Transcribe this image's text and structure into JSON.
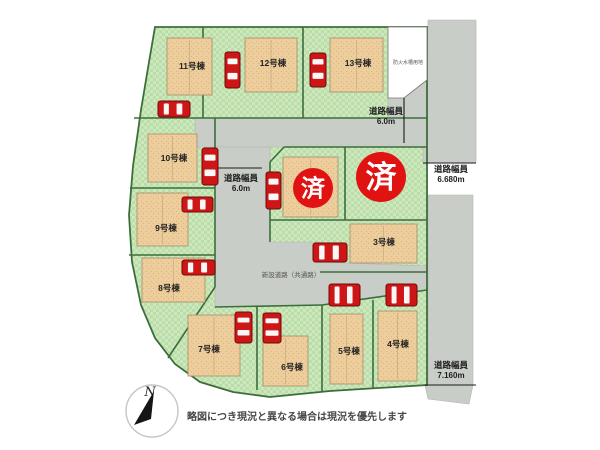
{
  "map": {
    "background": "#ffffff",
    "palette": {
      "grass": "#badda9",
      "grass_alt": "#cde8bd",
      "sand": "#edcd9c",
      "sand_dot": "#d9b57f",
      "road": "#c9cdc7",
      "road_edge": "#b2b6b0",
      "line": "#3c6e3c",
      "building_stroke": "#a38f6b",
      "building_inner": "#c8a97c",
      "car_red": "#cf1616",
      "car_dark": "#6d0a0a",
      "car_window": "#f7f7f7",
      "badge_red": "#e01212",
      "badge_text": "#ffffff",
      "text": "#222222",
      "road_text": "#1d1d1d",
      "small_text": "#555555",
      "caption_color": "#474747",
      "tick": "#1a1a1a",
      "parcel_fill": "#ffffff",
      "parcel_stroke": "#777777"
    },
    "site_outline": "155,27 427,27 427,385 330,391 270,397 233,392 200,382 175,364 155,338 141,305 132,262 129,215 133,166 141,110 149,62",
    "roads": [
      {
        "name": "road-north",
        "points": "195,118 388,118 388,98 404,98 427,80 428,20 476,20 476,163 423,163 423,147 195,147"
      },
      {
        "name": "road-center",
        "points": "215,147 270,147 270,242 320,242 320,262 427,266 427,290 322,305 215,307"
      },
      {
        "name": "road-east-mid",
        "points": "428,195 473,195 473,385 428,385"
      },
      {
        "name": "road-east-bottom",
        "points": "425,385 473,385 469,404 428,399"
      }
    ],
    "boundary_lines": [
      [
        203,
        27,
        203,
        118
      ],
      [
        303,
        27,
        303,
        118
      ],
      [
        134,
        118,
        428,
        118
      ],
      [
        130,
        188,
        215,
        188
      ],
      [
        129,
        255,
        215,
        255
      ],
      [
        215,
        118,
        215,
        287
      ],
      [
        215,
        287,
        168,
        358
      ],
      [
        257,
        307,
        257,
        390
      ],
      [
        322,
        305,
        322,
        392
      ],
      [
        373,
        300,
        373,
        389
      ],
      [
        270,
        162,
        284,
        147
      ],
      [
        284,
        147,
        427,
        147
      ],
      [
        270,
        162,
        270,
        242
      ],
      [
        345,
        147,
        345,
        220
      ],
      [
        270,
        220,
        427,
        220
      ],
      [
        320,
        272,
        427,
        272
      ],
      [
        215,
        307,
        322,
        305
      ],
      [
        322,
        305,
        427,
        290
      ]
    ],
    "white_parcel": {
      "points": "388,27 427,27 427,80 404,98 388,98",
      "label": "防火水槽用地",
      "label_x": 408,
      "label_y": 64
    },
    "buildings": [
      {
        "x": 167,
        "y": 38,
        "w": 45,
        "h": 57
      },
      {
        "x": 245,
        "y": 38,
        "w": 52,
        "h": 54
      },
      {
        "x": 330,
        "y": 38,
        "w": 53,
        "h": 54
      },
      {
        "x": 148,
        "y": 134,
        "w": 49,
        "h": 48
      },
      {
        "x": 137,
        "y": 193,
        "w": 51,
        "h": 53
      },
      {
        "x": 142,
        "y": 258,
        "w": 63,
        "h": 44
      },
      {
        "x": 188,
        "y": 315,
        "w": 52,
        "h": 61
      },
      {
        "x": 263,
        "y": 336,
        "w": 45,
        "h": 50
      },
      {
        "x": 330,
        "y": 314,
        "w": 33,
        "h": 70
      },
      {
        "x": 378,
        "y": 311,
        "w": 39,
        "h": 70
      },
      {
        "x": 350,
        "y": 224,
        "w": 67,
        "h": 39
      },
      {
        "x": 283,
        "y": 157,
        "w": 55,
        "h": 60
      }
    ],
    "lot_labels": [
      {
        "text": "11号棟",
        "x": 192,
        "y": 69
      },
      {
        "text": "12号棟",
        "x": 273,
        "y": 66
      },
      {
        "text": "13号棟",
        "x": 358,
        "y": 66
      },
      {
        "text": "10号棟",
        "x": 174,
        "y": 161
      },
      {
        "text": "9号棟",
        "x": 166,
        "y": 231
      },
      {
        "text": "8号棟",
        "x": 169,
        "y": 291
      },
      {
        "text": "7号棟",
        "x": 209,
        "y": 352
      },
      {
        "text": "6号棟",
        "x": 292,
        "y": 370
      },
      {
        "text": "5号棟",
        "x": 349,
        "y": 354
      },
      {
        "text": "4号棟",
        "x": 398,
        "y": 347
      },
      {
        "text": "3号棟",
        "x": 384,
        "y": 245
      }
    ],
    "cars": [
      {
        "x": 225,
        "y": 52,
        "w": 15,
        "h": 36,
        "dir": "v"
      },
      {
        "x": 310,
        "y": 53,
        "w": 16,
        "h": 34,
        "dir": "v"
      },
      {
        "x": 158,
        "y": 101,
        "w": 32,
        "h": 16,
        "dir": "h"
      },
      {
        "x": 202,
        "y": 148,
        "w": 16,
        "h": 37,
        "dir": "v"
      },
      {
        "x": 266,
        "y": 172,
        "w": 15,
        "h": 37,
        "dir": "v"
      },
      {
        "x": 182,
        "y": 197,
        "w": 31,
        "h": 15,
        "dir": "h"
      },
      {
        "x": 182,
        "y": 260,
        "w": 33,
        "h": 15,
        "dir": "h"
      },
      {
        "x": 313,
        "y": 243,
        "w": 34,
        "h": 19,
        "dir": "h"
      },
      {
        "x": 235,
        "y": 312,
        "w": 17,
        "h": 31,
        "dir": "v"
      },
      {
        "x": 263,
        "y": 313,
        "w": 18,
        "h": 30,
        "dir": "v"
      },
      {
        "x": 329,
        "y": 284,
        "w": 31,
        "h": 22,
        "dir": "h"
      },
      {
        "x": 386,
        "y": 284,
        "w": 31,
        "h": 22,
        "dir": "h"
      }
    ],
    "sold_badges": [
      {
        "text": "済",
        "cx": 313,
        "cy": 188,
        "r": 20,
        "font": 24
      },
      {
        "text": "済",
        "cx": 381,
        "cy": 177,
        "r": 25,
        "font": 31
      }
    ],
    "road_width_labels": [
      {
        "line1": "道路幅員",
        "line2": "6.0m",
        "x": 386,
        "y": 114,
        "tick": [
          404,
          98,
          404,
          143
        ]
      },
      {
        "line1": "道路幅員",
        "line2": "6.0m",
        "x": 241,
        "y": 181,
        "tick": [
          218,
          168,
          262,
          168
        ]
      },
      {
        "line1": "道路幅員",
        "line2": "6.680m",
        "x": 451,
        "y": 172,
        "tick": [
          423,
          163,
          476,
          163
        ]
      },
      {
        "line1": "道路幅員",
        "line2": "7.160m",
        "x": 451,
        "y": 368,
        "tick": [
          425,
          385,
          476,
          385
        ]
      }
    ],
    "road_name": {
      "text": "新設道路（共通路）",
      "x": 291,
      "y": 277
    },
    "compass": {
      "cx": 152,
      "cy": 411,
      "r": 26,
      "letter": "N",
      "needle": "154,391 134,425 151,419"
    },
    "caption": {
      "text": "略図につき現況と異なる場合は現況を優先します",
      "x": 297,
      "y": 420
    }
  }
}
